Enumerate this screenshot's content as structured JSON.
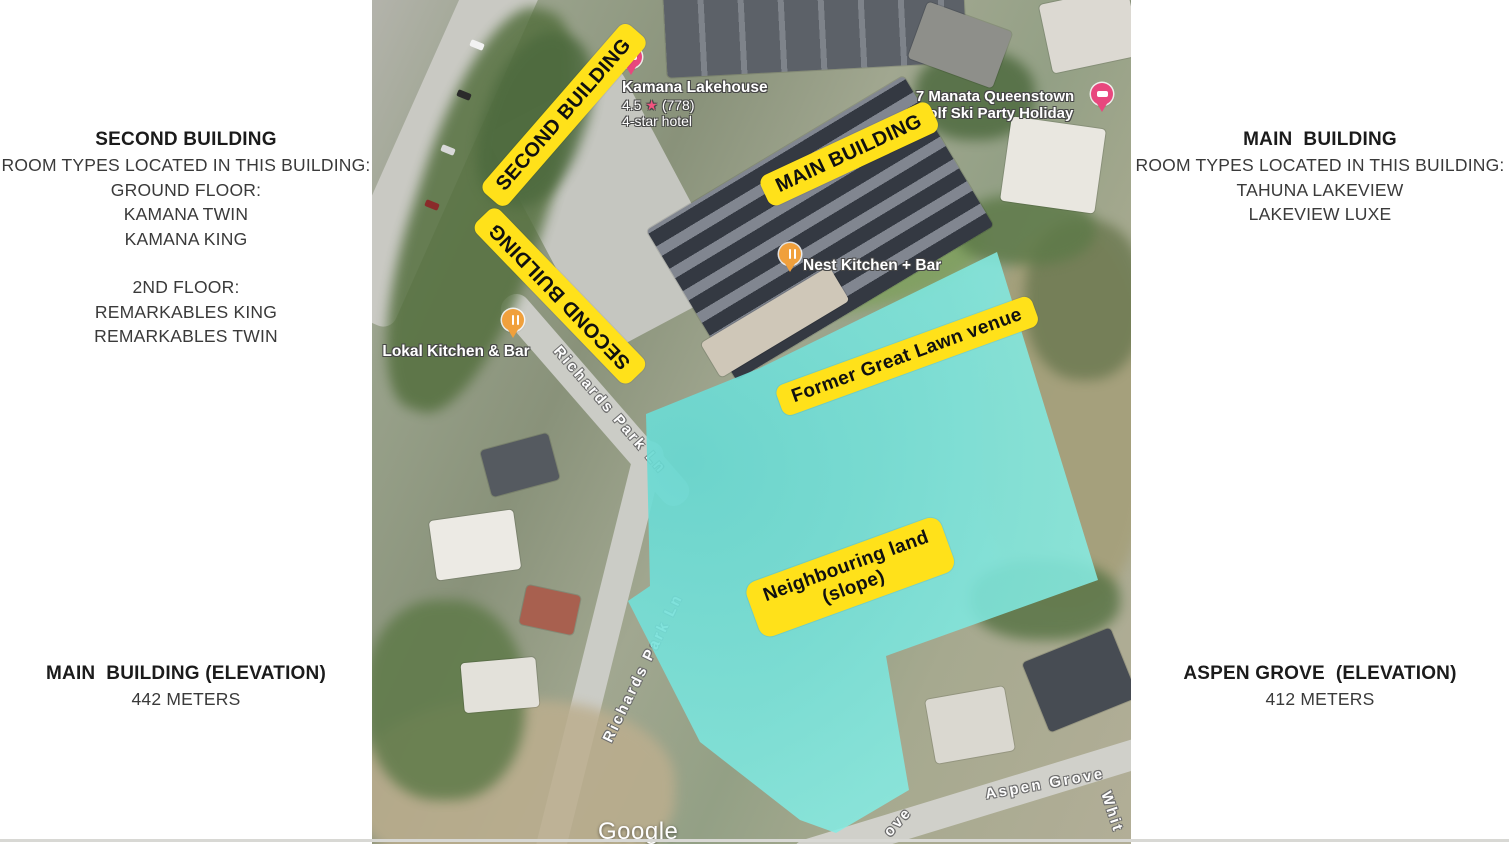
{
  "left_panel": {
    "building_info": {
      "title": "SECOND BUILDING",
      "line1": "ROOM TYPES LOCATED IN THIS BUILDING:",
      "line2": "GROUND FLOOR:",
      "line3": "KAMANA TWIN",
      "line4": "KAMANA KING",
      "line5": "2ND FLOOR:",
      "line6": "REMARKABLES KING",
      "line7": "REMARKABLES TWIN"
    },
    "elevation": {
      "title": "MAIN  BUILDING (ELEVATION)",
      "value": "442 METERS"
    }
  },
  "right_panel": {
    "building_info": {
      "title": "MAIN  BUILDING",
      "line1": "ROOM TYPES LOCATED IN THIS BUILDING:",
      "line2": "TAHUNA LAKEVIEW",
      "line3": "LAKEVIEW LUXE"
    },
    "elevation": {
      "title": "ASPEN GROVE  (ELEVATION)",
      "value": "412 METERS"
    }
  },
  "map": {
    "annotation_labels": {
      "second_building_diag": "SECOND BUILDING",
      "second_building_vert": "SECOND BUILDING",
      "main_building": "MAIN BUILDING",
      "former_great_lawn": "Former Great Lawn venue",
      "neighbouring_land_line1": "Neighbouring land",
      "neighbouring_land_line2": "(slope)"
    },
    "pois": {
      "kamana": {
        "name": "Kamana Lakehouse",
        "rating": "4.5",
        "rating_star": "★",
        "reviews": "(778)",
        "category": "4-star hotel"
      },
      "manata": {
        "name_line1": "7 Manata Queenstown",
        "name_line2": "Golf Ski Party Holiday"
      },
      "nest": {
        "name": "Nest Kitchen + Bar"
      },
      "lokal": {
        "name": "Lokal Kitchen & Bar"
      }
    },
    "streets": {
      "richards_upper": "Richards Park Ln",
      "richards_lower": "Richards Park Ln",
      "aspen_grove": "Aspen Grove",
      "grove_partial": "ove",
      "whit_partial": "Whit"
    },
    "attribution": "Google",
    "colors": {
      "annotation_yellow": "#FFE11A",
      "highlight_cyan": "#7CE7DE",
      "hotel_pin": "#E8477E",
      "restaurant_pin": "#F0A03C",
      "map_label_text": "#FFFFFF"
    }
  }
}
